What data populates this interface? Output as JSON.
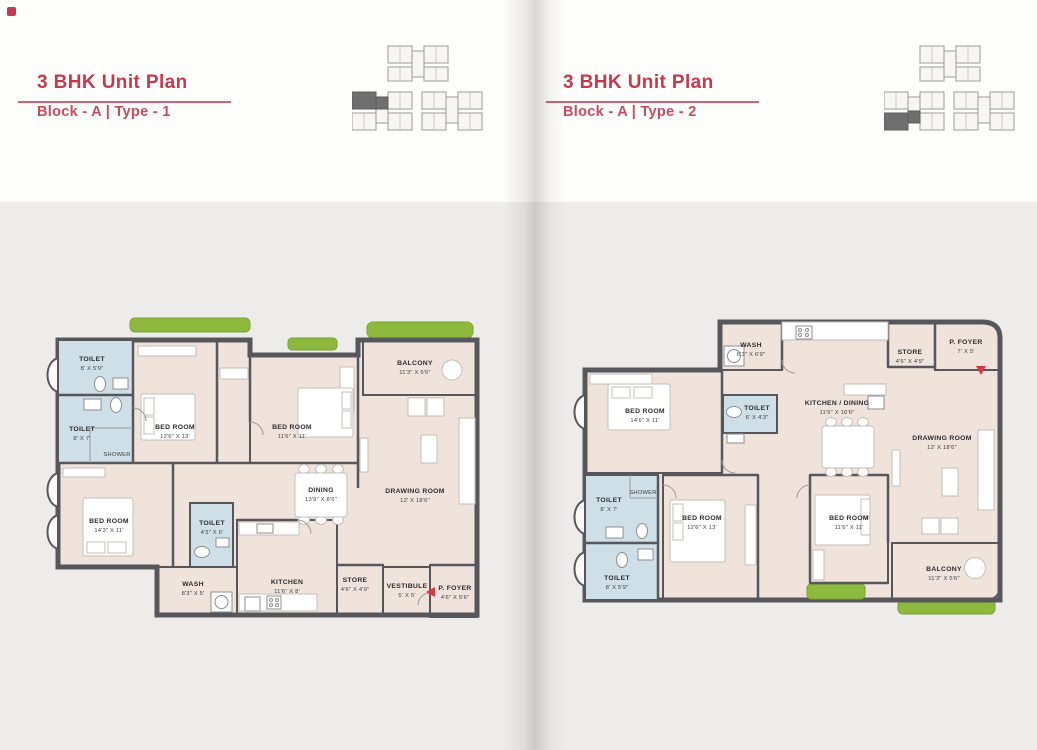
{
  "colors": {
    "accent": "#c33950",
    "wall": "#57575b",
    "floor": "#efe3dc",
    "bedroom_floor": "#e8dad2",
    "toilet_blue": "#cfdfe8",
    "balcony_wood": "#b98e59",
    "planter_green": "#8dba3e",
    "wash_gray": "#d5d3cb",
    "foyer_salmon": "#e4cec4",
    "entry_marker_red": "#d63948"
  },
  "pages": {
    "left": {
      "title": "3 BHK Unit Plan",
      "subtitle": "Block - A | Type - 1",
      "rooms": {
        "toilet_top": {
          "name": "TOILET",
          "dim": "8' X 5'9\""
        },
        "toilet_mid": {
          "name": "TOILET",
          "dim": "8' X 7'"
        },
        "shower": {
          "name": "SHOWER"
        },
        "bed_master": {
          "name": "BED ROOM",
          "dim": "12'6\" X 13'"
        },
        "bed_second": {
          "name": "BED ROOM",
          "dim": "11'6\" X 11'"
        },
        "balcony": {
          "name": "BALCONY",
          "dim": "11'3\" X 5'6\""
        },
        "drawing": {
          "name": "DRAWING ROOM",
          "dim": "12' X 18'6\""
        },
        "dining": {
          "name": "DINING",
          "dim": "13'9\" X 8'6\""
        },
        "bed_third": {
          "name": "BED ROOM",
          "dim": "14'3\" X 11'"
        },
        "toilet_small": {
          "name": "TOILET",
          "dim": "4'3\" X 6'"
        },
        "wash": {
          "name": "WASH",
          "dim": "8'3\" X 5'"
        },
        "kitchen": {
          "name": "KITCHEN",
          "dim": "11'6\" X 8'"
        },
        "store": {
          "name": "STORE",
          "dim": "4'6\" X 4'9\""
        },
        "vestibule": {
          "name": "VESTIBULE",
          "dim": "5' X 5'"
        },
        "p_foyer": {
          "name": "P. FOYER",
          "dim": "4'6\" X 5'6\""
        }
      }
    },
    "right": {
      "title": "3 BHK Unit Plan",
      "subtitle": "Block - A | Type - 2",
      "rooms": {
        "wash": {
          "name": "WASH",
          "dim": "6'3\" X 6'9\""
        },
        "store": {
          "name": "STORE",
          "dim": "4'6\" X 4'9\""
        },
        "p_foyer": {
          "name": "P. FOYER",
          "dim": "7' X 5'"
        },
        "bed_master": {
          "name": "BED ROOM",
          "dim": "14'6\" X 11'"
        },
        "toilet_small": {
          "name": "TOILET",
          "dim": "6' X 4'3\""
        },
        "kitchen_dining": {
          "name": "KITCHEN / DINING",
          "dim": "11'6\" X 16'6\""
        },
        "drawing": {
          "name": "DRAWING ROOM",
          "dim": "12' X 18'6\""
        },
        "toilet_mid": {
          "name": "TOILET",
          "dim": "8' X 7'"
        },
        "shower": {
          "name": "SHOWER"
        },
        "toilet_bottom": {
          "name": "TOILET",
          "dim": "8' X 5'9\""
        },
        "bed_second": {
          "name": "BED ROOM",
          "dim": "12'6\" X 13'"
        },
        "bed_third": {
          "name": "BED ROOM",
          "dim": "11'6\" X 11'"
        },
        "balcony": {
          "name": "BALCONY",
          "dim": "11'3\" X 5'6\""
        }
      }
    }
  }
}
